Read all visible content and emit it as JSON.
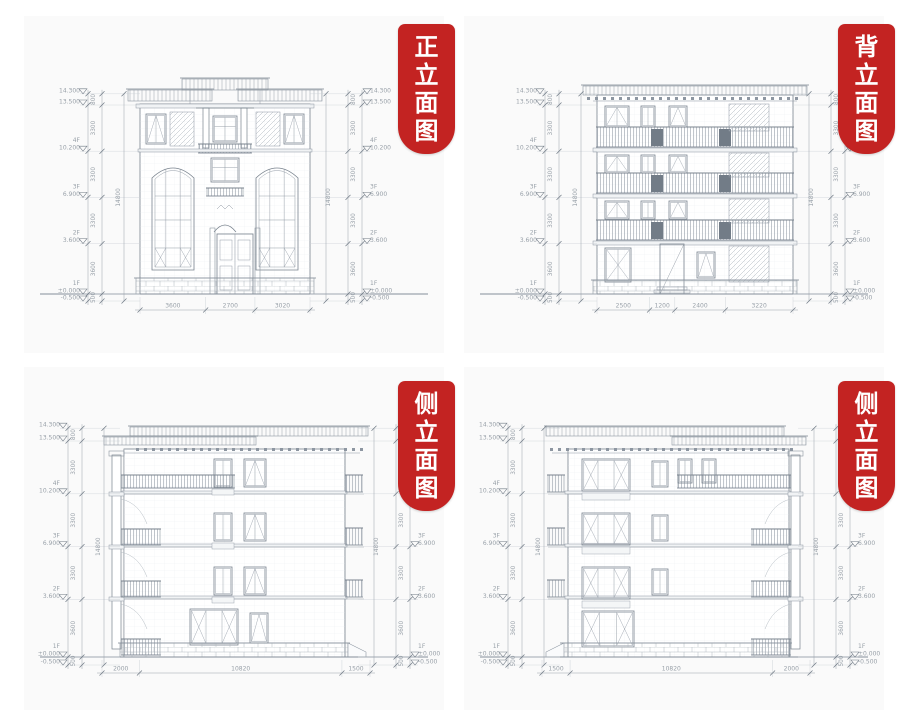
{
  "page": {
    "background": "#ffffff",
    "panel_background": "#fafafa"
  },
  "colors": {
    "accent_red": "#c32322",
    "drawing_line": "#8d96a1",
    "dim_text": "#99a1a9"
  },
  "panels": [
    {
      "id": "front-elevation",
      "label": "正立面图",
      "label_chars": [
        "正",
        "立",
        "面",
        "图"
      ],
      "levels": [
        {
          "floor": "",
          "elev": "14.300"
        },
        {
          "floor": "",
          "elev": "13.500"
        },
        {
          "floor": "4F",
          "elev": "10.200"
        },
        {
          "floor": "3F",
          "elev": "6.900"
        },
        {
          "floor": "2F",
          "elev": "3.600"
        },
        {
          "floor": "1F",
          "elev": "±0.000"
        },
        {
          "floor": "",
          "elev": "-0.500"
        }
      ],
      "segment_dims": [
        "800",
        "3300",
        "3300",
        "3300",
        "3600",
        "500"
      ],
      "total_height": "14800",
      "bottom_dims": [
        "3600",
        "2700",
        "3020"
      ]
    },
    {
      "id": "back-elevation",
      "label": "背立面图",
      "label_chars": [
        "背",
        "立",
        "面",
        "图"
      ],
      "levels": [
        {
          "floor": "",
          "elev": "14.300"
        },
        {
          "floor": "",
          "elev": "13.500"
        },
        {
          "floor": "4F",
          "elev": "10.200"
        },
        {
          "floor": "3F",
          "elev": "6.900"
        },
        {
          "floor": "2F",
          "elev": "3.600"
        },
        {
          "floor": "1F",
          "elev": "±0.000"
        },
        {
          "floor": "",
          "elev": "-0.500"
        }
      ],
      "segment_dims": [
        "800",
        "3300",
        "3300",
        "3300",
        "3600",
        "500"
      ],
      "total_height": "14800",
      "bottom_dims": [
        "2500",
        "1200",
        "2400",
        "3220"
      ]
    },
    {
      "id": "side-elevation-left",
      "label": "侧立面图",
      "label_chars": [
        "侧",
        "立",
        "面",
        "图"
      ],
      "levels": [
        {
          "floor": "",
          "elev": "14.300"
        },
        {
          "floor": "",
          "elev": "13.500"
        },
        {
          "floor": "4F",
          "elev": "10.200"
        },
        {
          "floor": "3F",
          "elev": "6.900"
        },
        {
          "floor": "2F",
          "elev": "3.600"
        },
        {
          "floor": "1F",
          "elev": "±0.000"
        },
        {
          "floor": "",
          "elev": "-0.500"
        }
      ],
      "segment_dims": [
        "800",
        "3300",
        "3300",
        "3300",
        "3600",
        "500"
      ],
      "total_height": "14800",
      "bottom_dims": [
        "2000",
        "10820",
        "1500"
      ]
    },
    {
      "id": "side-elevation-right",
      "label": "侧立面图",
      "label_chars": [
        "侧",
        "立",
        "面",
        "图"
      ],
      "levels": [
        {
          "floor": "",
          "elev": "14.300"
        },
        {
          "floor": "",
          "elev": "13.500"
        },
        {
          "floor": "4F",
          "elev": "10.200"
        },
        {
          "floor": "3F",
          "elev": "6.900"
        },
        {
          "floor": "2F",
          "elev": "3.600"
        },
        {
          "floor": "1F",
          "elev": "±0.000"
        },
        {
          "floor": "",
          "elev": "-0.500"
        }
      ],
      "segment_dims": [
        "800",
        "3300",
        "3300",
        "3300",
        "3600",
        "500"
      ],
      "total_height": "14800",
      "bottom_dims": [
        "1500",
        "10820",
        "2000"
      ]
    }
  ]
}
